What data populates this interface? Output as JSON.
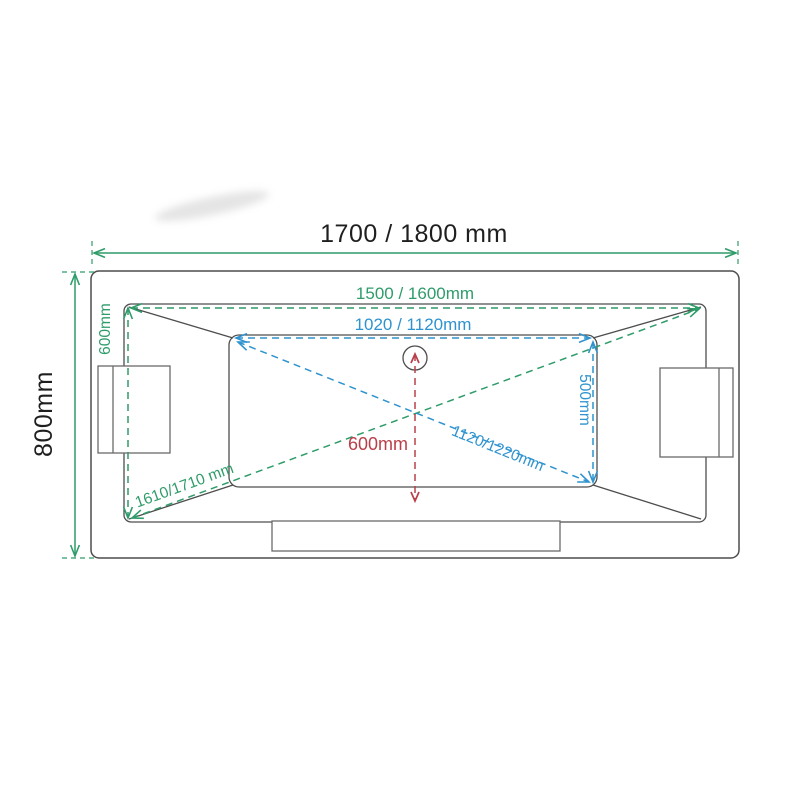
{
  "labels": {
    "overall_length": "1700 / 1800 mm",
    "overall_width": "800mm",
    "rim_length": "1500 / 1600mm",
    "rim_width": "600mm",
    "rim_diagonal": "1610/1710 mm",
    "basin_length": "1020 / 1120mm",
    "basin_width": "500mm",
    "basin_diagonal": "1120/1220mm",
    "drain_to_edge": "600mm"
  },
  "colors": {
    "overall_dim_green": "#2f9c6a",
    "basin_dim_blue": "#2e93cf",
    "drain_dim_red": "#b9404a",
    "outline_gray": "#4d4d4d",
    "outline_light": "#6a6a6a",
    "text_black": "#1f1f1f"
  }
}
